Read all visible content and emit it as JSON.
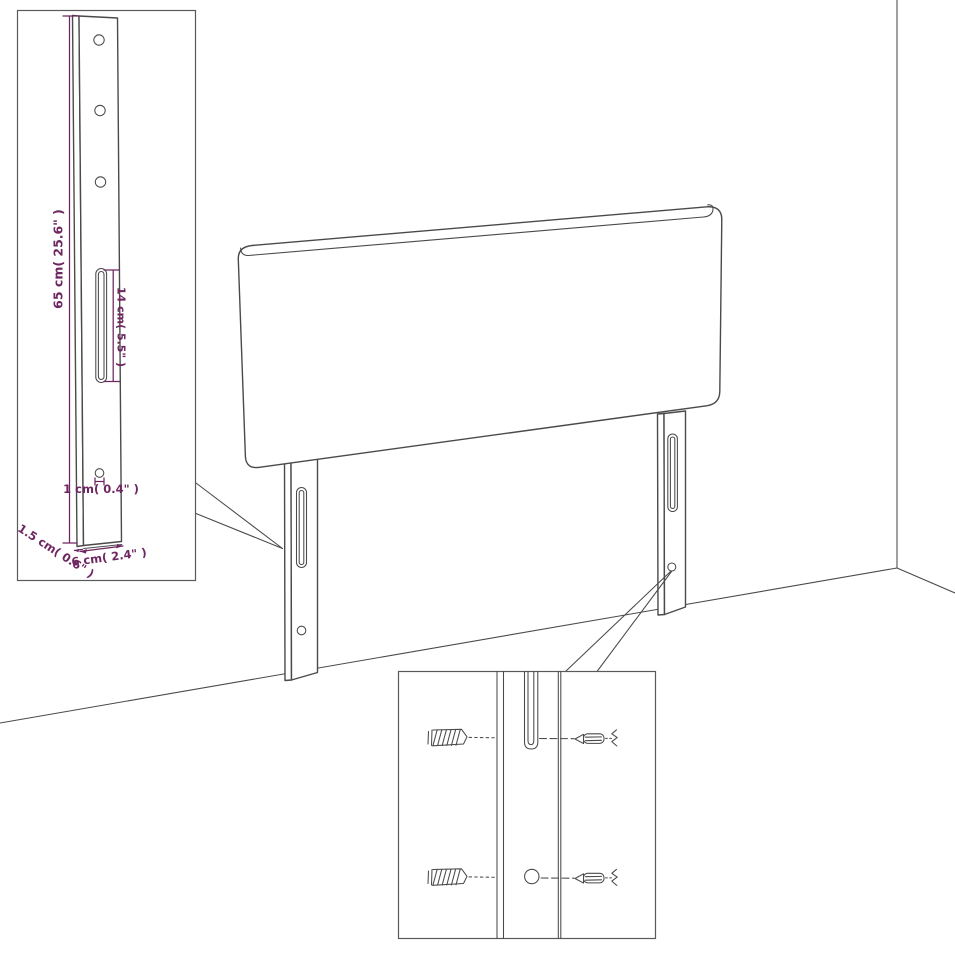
{
  "diagram": {
    "title": "headboard-assembly-dimension-diagram",
    "colors": {
      "line": "#4a4a4a",
      "dimension": "#6e2660",
      "background": "#ffffff",
      "border": "#5a5a5a"
    },
    "dimensions": {
      "bracket_height": "65 cm( 25.6\" )",
      "slot_length": "14 cm( 5.5\" )",
      "hole_diameter": "1 cm( 0.4\" )",
      "bracket_thickness": "1.5 cm( 0.6\" )",
      "bracket_width": "6 cm( 2.4\" )"
    }
  }
}
